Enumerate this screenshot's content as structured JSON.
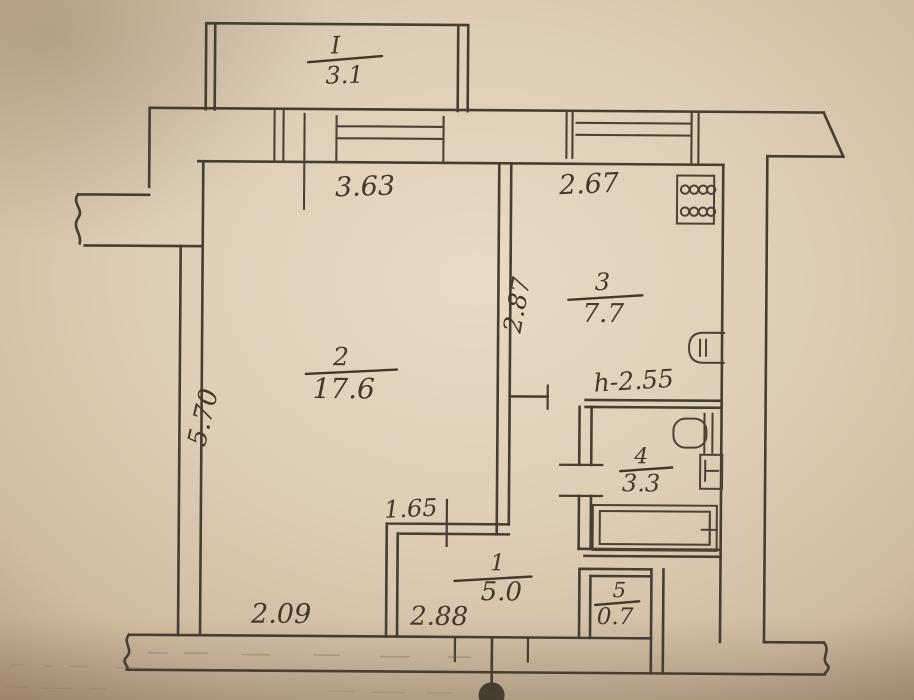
{
  "palette": {
    "paper": "#ddceb6",
    "paper_edge": "#bfa98d",
    "pencil": "#473d30",
    "ink_note": "#5d4b8e"
  },
  "plan": {
    "balcony": {
      "number": "I",
      "area": "3.1"
    },
    "rooms": {
      "living": {
        "number": "2",
        "area": "17.6"
      },
      "kitchen": {
        "number": "3",
        "area": "7.7"
      },
      "bathroom": {
        "number": "4",
        "area": "3.3"
      },
      "hallway": {
        "number": "1",
        "area": "5.0"
      },
      "closet": {
        "number": "5",
        "area": "0.7"
      }
    },
    "dimensions": {
      "living_width_top": "3.63",
      "kitchen_width_top": "2.67",
      "living_height_left": "5.70",
      "kitchen_depth_side": "2.87",
      "ceiling_height_note": "h-2.55",
      "nook_width": "1.65",
      "bottom_left_width": "2.09",
      "bottom_middle_width": "2.88"
    },
    "fixtures": {
      "stove": "stove-icon",
      "kitchen_sink": "kitchen-sink-icon",
      "toilet": "toilet-icon",
      "washbasin": "washbasin-icon",
      "bathtub": "bathtub-icon",
      "entrance": "entrance-door-icon"
    }
  }
}
